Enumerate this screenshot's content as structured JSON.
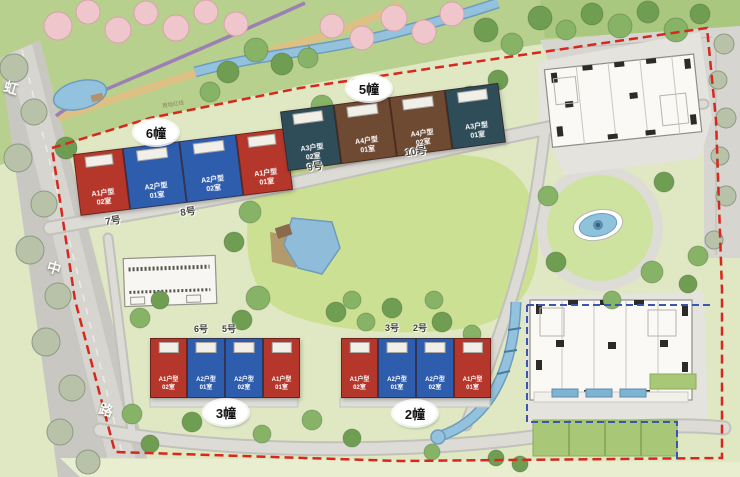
{
  "street": {
    "name": "虹中路",
    "chars": [
      "虹",
      "中",
      "路"
    ]
  },
  "roads": {
    "labels": [
      "7号",
      "8号",
      "9号",
      "10号"
    ]
  },
  "annotations": {
    "boundary_note": "用地红线"
  },
  "buildings": [
    {
      "badge": "6幢",
      "units": [
        {
          "type": "A1户型",
          "room": "02室",
          "color": "red"
        },
        {
          "type": "A2户型",
          "room": "01室",
          "color": "blue"
        },
        {
          "type": "A2户型",
          "room": "02室",
          "color": "blue"
        },
        {
          "type": "A1户型",
          "room": "01室",
          "color": "red"
        }
      ]
    },
    {
      "badge": "5幢",
      "units": [
        {
          "type": "A3户型",
          "room": "02室",
          "color": "teal"
        },
        {
          "type": "A4户型",
          "room": "01室",
          "color": "brown"
        },
        {
          "type": "A4户型",
          "room": "02室",
          "color": "brown"
        },
        {
          "type": "A3户型",
          "room": "01室",
          "color": "teal"
        }
      ]
    },
    {
      "badge": "3幢",
      "entrances": [
        "6号",
        "5号"
      ],
      "units": [
        {
          "type": "A1户型",
          "room": "02室",
          "color": "red"
        },
        {
          "type": "A2户型",
          "room": "01室",
          "color": "blue"
        },
        {
          "type": "A2户型",
          "room": "02室",
          "color": "blue"
        },
        {
          "type": "A1户型",
          "room": "01室",
          "color": "red"
        }
      ]
    },
    {
      "badge": "2幢",
      "entrances": [
        "3号",
        "2号"
      ],
      "units": [
        {
          "type": "A1户型",
          "room": "02室",
          "color": "red"
        },
        {
          "type": "A2户型",
          "room": "01室",
          "color": "blue"
        },
        {
          "type": "A2户型",
          "room": "02室",
          "color": "blue"
        },
        {
          "type": "A1户型",
          "room": "01室",
          "color": "red"
        }
      ]
    }
  ],
  "palette": {
    "unit_red": "#b5372b",
    "unit_blue": "#2f5dad",
    "unit_teal": "#2f4c59",
    "unit_brown": "#6e4a33",
    "boundary_red": "#d6281c",
    "overlay_blue": "#3a57b0",
    "water_blue": "#93c2de",
    "lawn_green": "#cce093",
    "road_gray": "#dcdbd5"
  }
}
